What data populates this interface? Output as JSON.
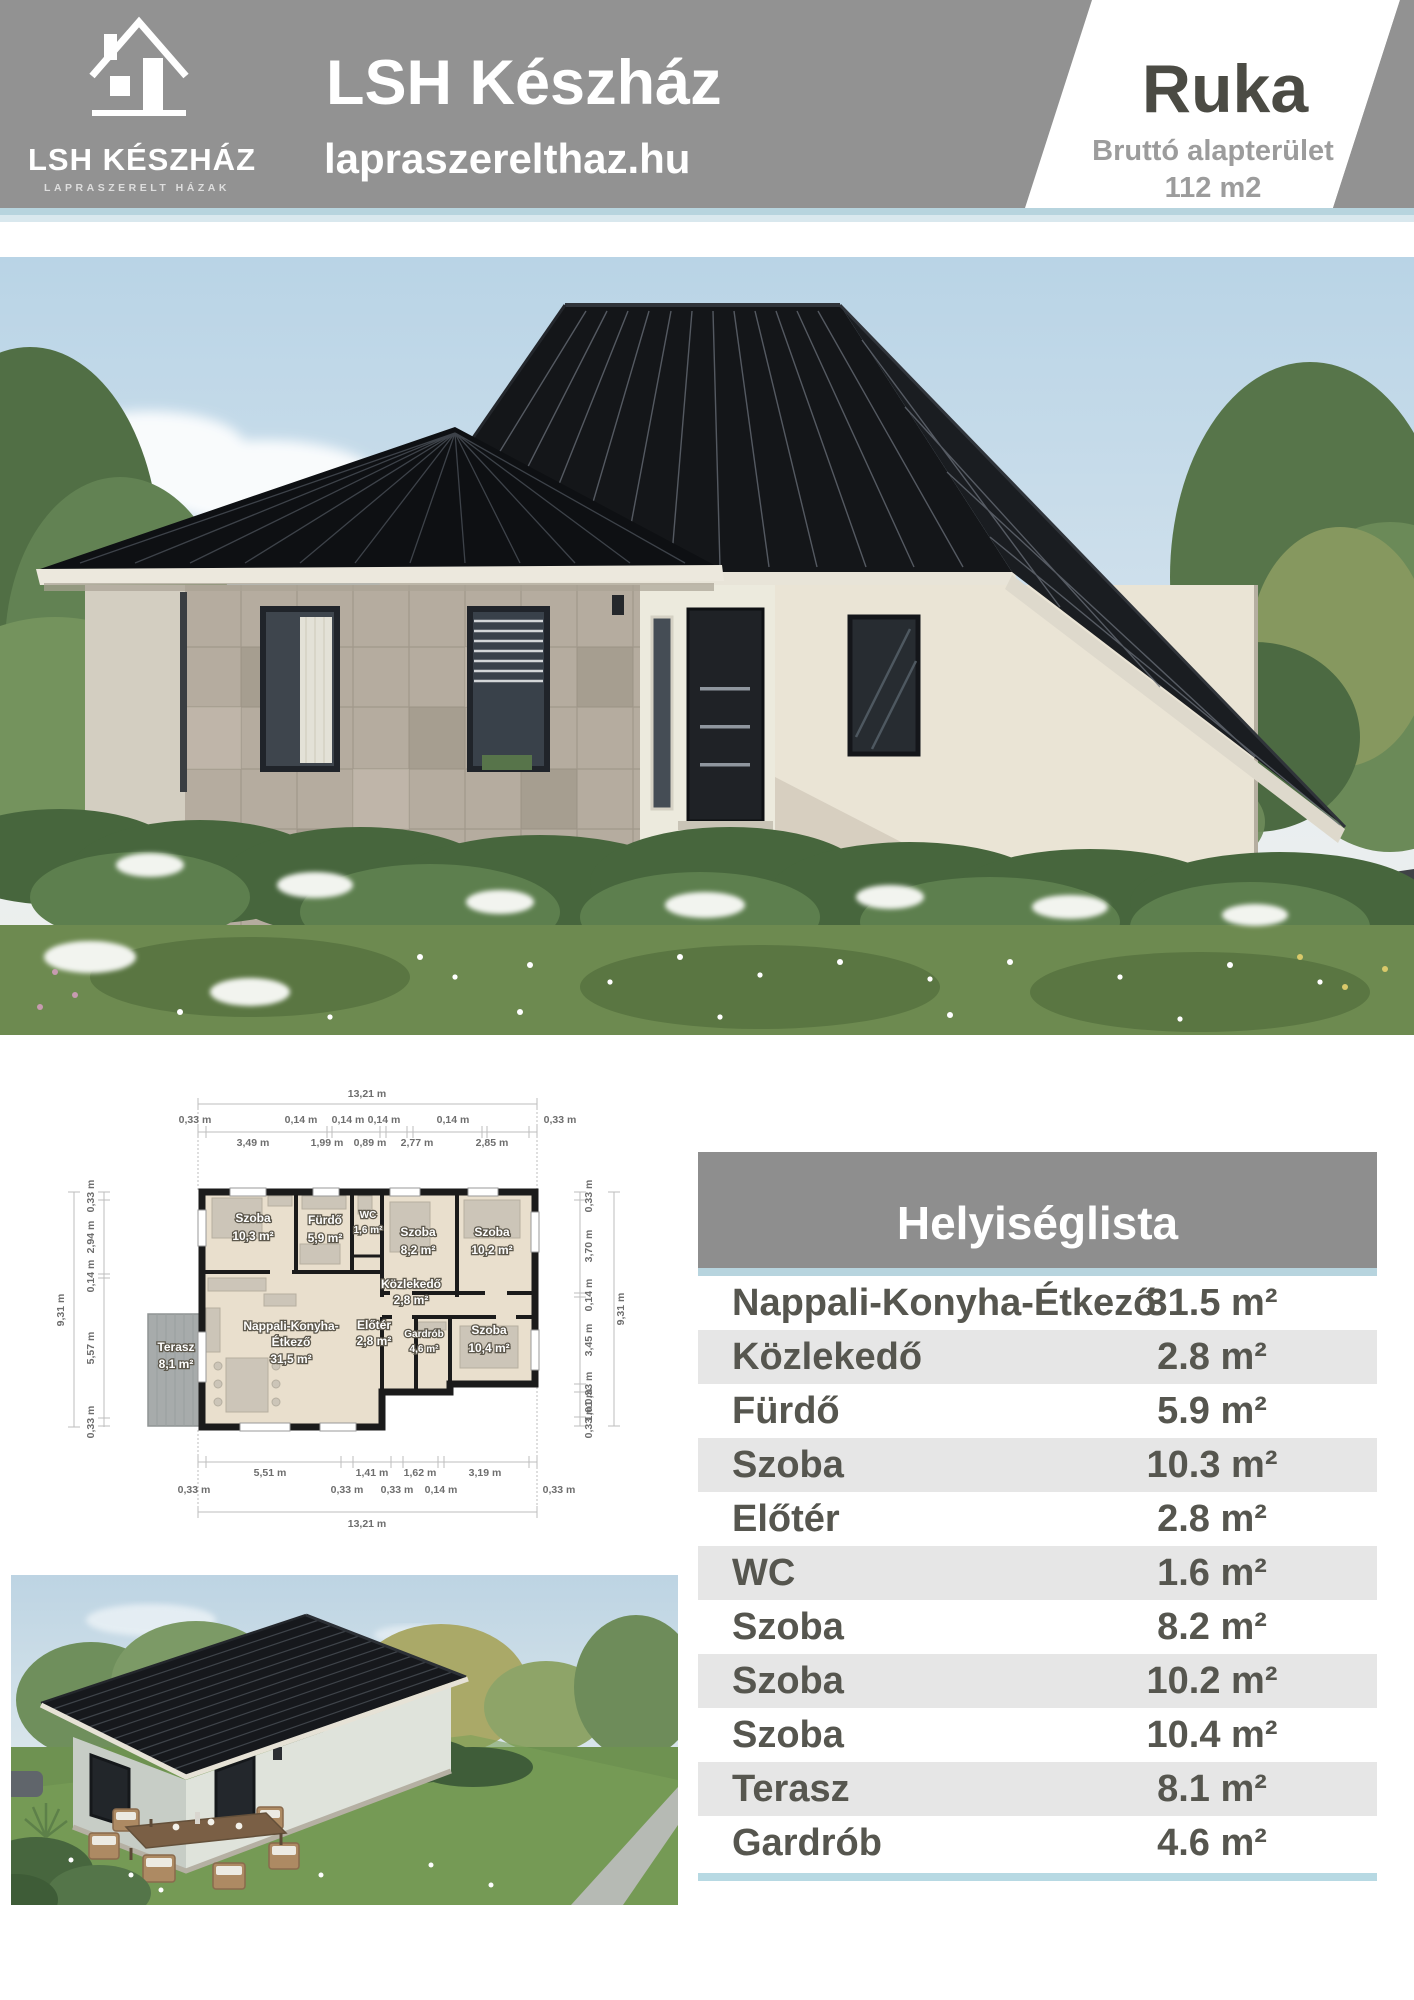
{
  "header": {
    "logo": {
      "name": "LSH KÉSZHÁZ",
      "tagline": "LAPRASZERELT HÁZAK"
    },
    "title": "LSH Készház",
    "website": "lapraszerelthaz.hu",
    "model": {
      "name": "Ruka",
      "area_label": "Bruttó alapterület",
      "area_value": "112 m2"
    }
  },
  "floorplan": {
    "dims": {
      "top_total": "13,21 m",
      "top_walls": [
        "0,33 m",
        "0,14 m",
        "0,14 m",
        "0,14 m",
        "0,14 m",
        "0,33 m"
      ],
      "top_segments": [
        "3,49 m",
        "1,99 m",
        "0,89 m",
        "2,77 m",
        "2,85 m"
      ],
      "left_total": "9,31 m",
      "left_chain": [
        "0,33 m",
        "2,94 m",
        "0,14 m",
        "5,57 m",
        "0,33 m"
      ],
      "right_total": "9,31 m",
      "right_chain": [
        "0,33 m",
        "3,70 m",
        "0,14 m",
        "3,45 m",
        "0,33 m",
        "1,01 m",
        "0,33 m"
      ],
      "bottom_segments": [
        "5,51 m",
        "1,41 m",
        "1,62 m",
        "3,19 m"
      ],
      "bottom_walls": [
        "0,33 m",
        "0,33 m",
        "0,33 m",
        "0,14 m",
        "0,33 m"
      ],
      "bottom_total": "13,21 m"
    },
    "rooms": [
      {
        "name": "Szoba",
        "area": "10,3 m²"
      },
      {
        "name": "Fürdő",
        "area": "5,9 m²"
      },
      {
        "name": "WC",
        "area": "1,6 m²"
      },
      {
        "name": "Szoba",
        "area": "8,2 m²"
      },
      {
        "name": "Szoba",
        "area": "10,2 m²"
      },
      {
        "name": "Közlekedő",
        "area": "2,8 m²"
      },
      {
        "name": "Nappali-Konyha-",
        "name2": "Étkező",
        "area": "31,5 m²"
      },
      {
        "name": "Előtér",
        "area": "2,8 m²"
      },
      {
        "name": "Gardrób",
        "area": "4,6 m²"
      },
      {
        "name": "Szoba",
        "area": "10,4 m²"
      },
      {
        "name": "Terasz",
        "area": "8,1 m²"
      }
    ]
  },
  "room_table": {
    "title": "Helyiséglista",
    "rows": [
      {
        "name": "Nappali-Konyha-Étkező",
        "area": "31.5 m²"
      },
      {
        "name": "Közlekedő",
        "area": "2.8 m²"
      },
      {
        "name": "Fürdő",
        "area": "5.9 m²"
      },
      {
        "name": "Szoba",
        "area": "10.3 m²"
      },
      {
        "name": "Előtér",
        "area": "2.8 m²"
      },
      {
        "name": "WC",
        "area": "1.6 m²"
      },
      {
        "name": "Szoba",
        "area": "8.2 m²"
      },
      {
        "name": "Szoba",
        "area": "10.2 m²"
      },
      {
        "name": "Szoba",
        "area": "10.4 m²"
      },
      {
        "name": "Terasz",
        "area": "8.1 m²"
      },
      {
        "name": "Gardrób",
        "area": "4.6 m²"
      }
    ]
  },
  "colors": {
    "header_gray": "#929292",
    "accent_blue": "#b7d4de",
    "row_stripe": "#e6e6e6",
    "table_text": "#56564f",
    "model_name_text": "#4b4b44",
    "roof_black": "#16181c"
  }
}
